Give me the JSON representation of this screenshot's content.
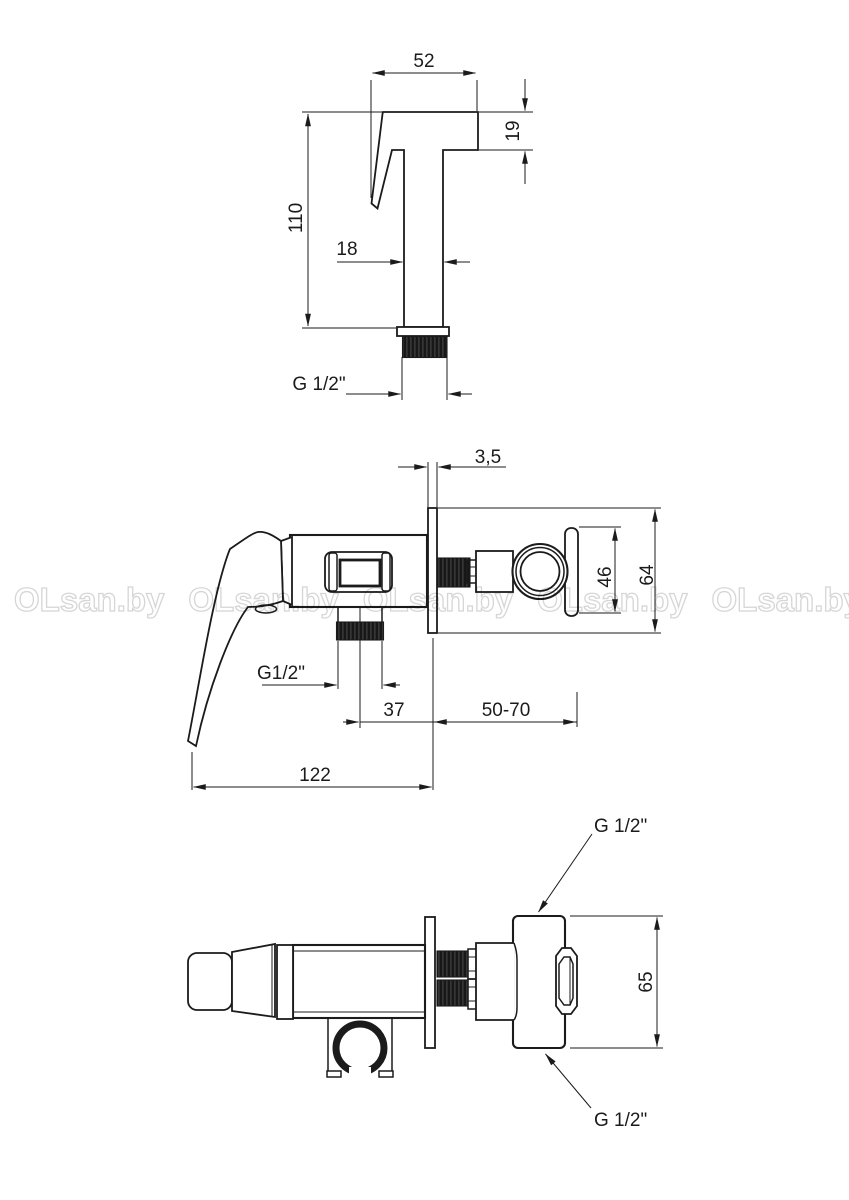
{
  "watermark": {
    "text": "OLsan.by"
  },
  "colors": {
    "line": "#1b1b1b",
    "thread_fill": "#171717",
    "watermark_stroke": "#d6d6d6",
    "background": "#ffffff"
  },
  "views": {
    "hand_shower": {
      "dims": {
        "head_width": "52",
        "head_height": "19",
        "total_height": "110",
        "body_width": "18",
        "thread": "G 1/2\""
      }
    },
    "mixer_side": {
      "dims": {
        "plate_thickness": "3,5",
        "eccentric_height": "46",
        "plate_height": "64",
        "outlet_thread": "G1/2\"",
        "outlet_to_wall": "37",
        "wall_to_inlet": "50-70",
        "total_length": "122"
      }
    },
    "mixer_top": {
      "dims": {
        "inlet_thread_top": "G 1/2\"",
        "body_height": "65",
        "inlet_thread_bottom": "G 1/2\""
      }
    }
  }
}
